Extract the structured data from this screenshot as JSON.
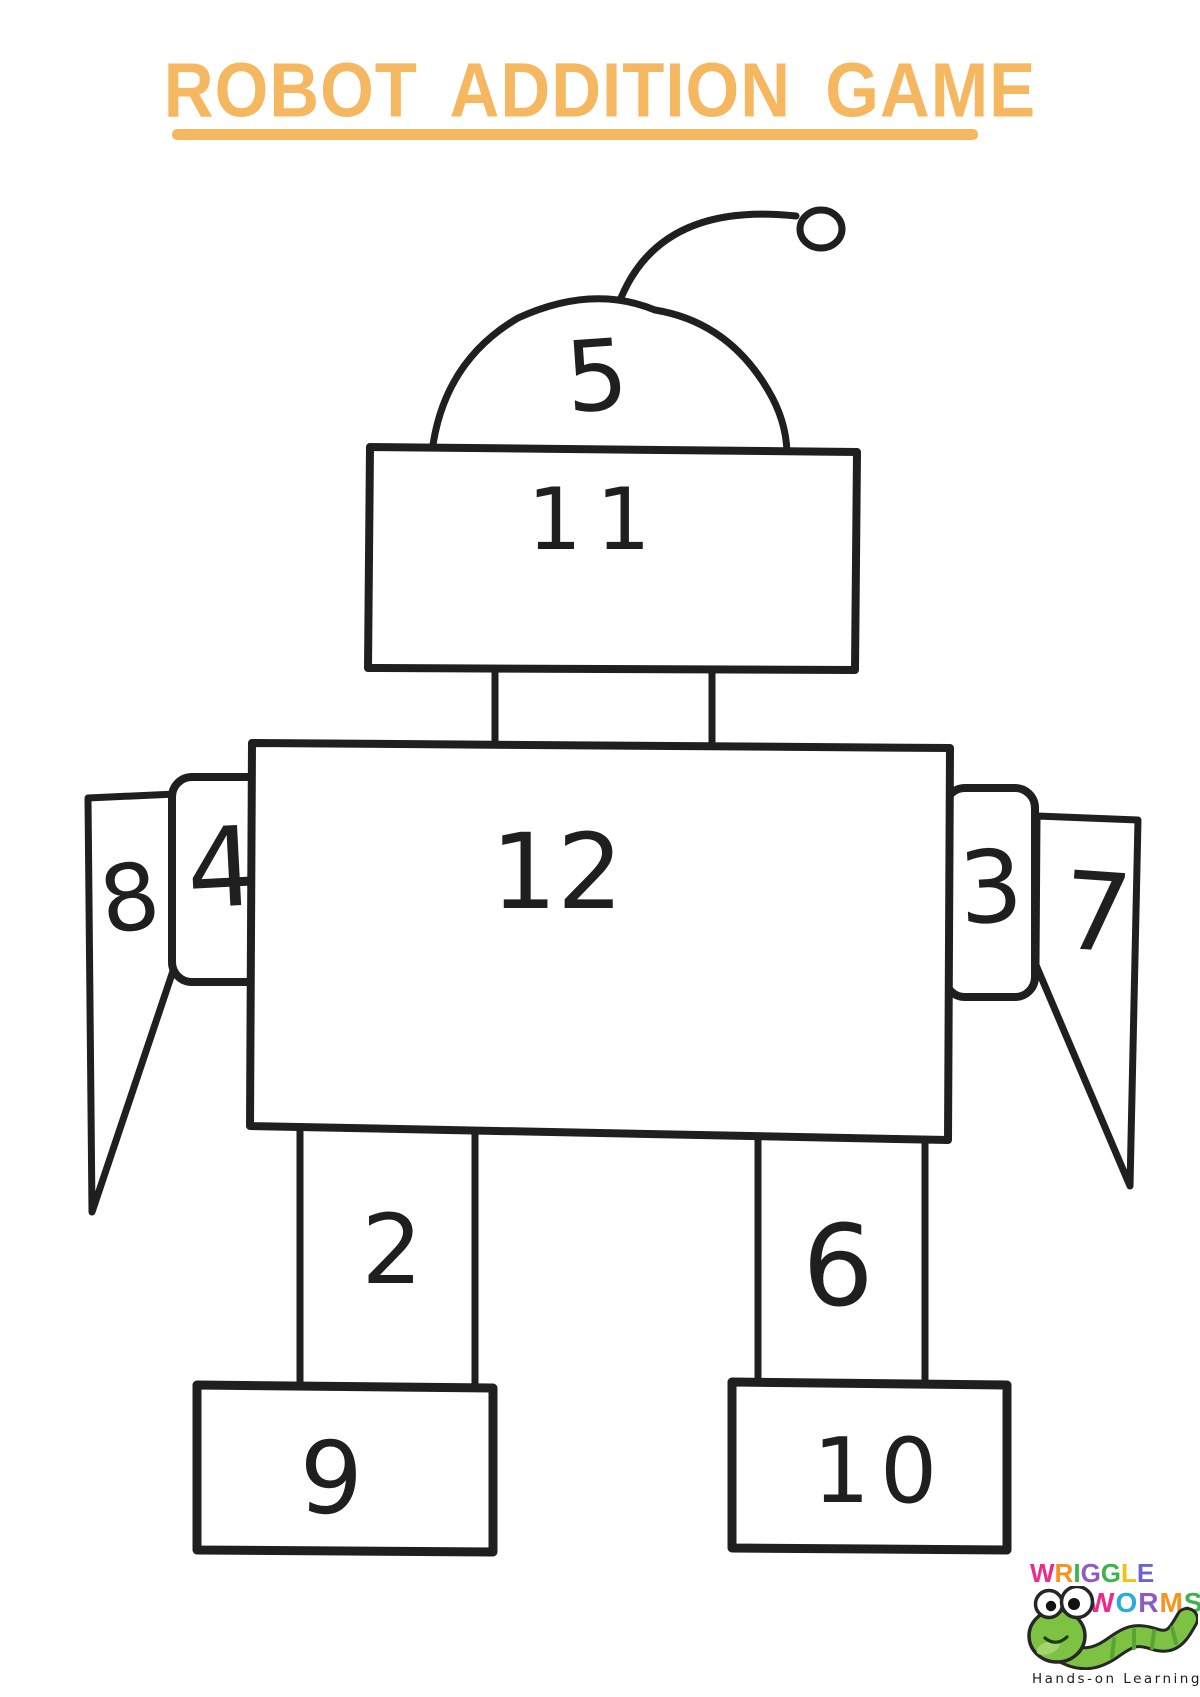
{
  "page": {
    "title": "ROBOT ADDITION GAME",
    "accent_color": "#F6B761",
    "ink_color": "#1f1f1f",
    "background": "#FFFFFF"
  },
  "robot": {
    "head_dome_value": "5",
    "head_value": "11",
    "body_value": "12",
    "left_shoulder_value": "4",
    "left_arm_value": "8",
    "right_shoulder_value": "3",
    "right_arm_value": "7",
    "left_leg_value": "2",
    "right_leg_value": "6",
    "left_foot_value": "9",
    "right_foot_value": "10"
  },
  "logo": {
    "wriggle_letters": [
      {
        "ch": "W",
        "color": "#EE2A8C"
      },
      {
        "ch": "R",
        "color": "#F7941D"
      },
      {
        "ch": "I",
        "color": "#3BB54A"
      },
      {
        "ch": "G",
        "color": "#9059C8"
      },
      {
        "ch": "G",
        "color": "#3BB54A"
      },
      {
        "ch": "L",
        "color": "#F2C00F"
      },
      {
        "ch": "E",
        "color": "#6C63D2"
      }
    ],
    "worms_letters": [
      {
        "ch": "W",
        "color": "#EE2A8C"
      },
      {
        "ch": "O",
        "color": "#29ABE2"
      },
      {
        "ch": "R",
        "color": "#8A5BC5"
      },
      {
        "ch": "M",
        "color": "#F7941D"
      },
      {
        "ch": "S",
        "color": "#3BB54A"
      }
    ],
    "tagline": "Hands-on Learning",
    "worm_green": "#7DC242",
    "worm_green_dark": "#58A333"
  }
}
